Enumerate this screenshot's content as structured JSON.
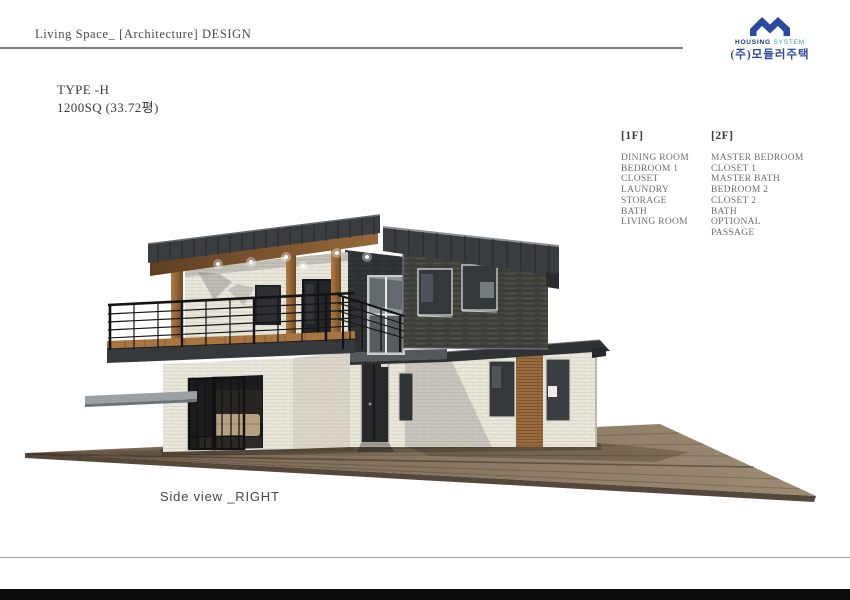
{
  "header": {
    "title": "Living Space_ [Architecture] DESIGN"
  },
  "logo": {
    "line1_strong": "HOUSING",
    "line1_light": "SYSTEM",
    "line2": "(주)모듈러주택"
  },
  "title": {
    "type": "TYPE -H",
    "area": "1200SQ (33.72평)"
  },
  "floors": [
    {
      "label": "[1F]",
      "rooms": [
        "DINING ROOM",
        "BEDROOM 1",
        "CLOSET",
        "LAUNDRY",
        "STORAGE",
        "BATH",
        "LIVING ROOM"
      ]
    },
    {
      "label": "[2F]",
      "rooms": [
        "MASTER BEDROOM",
        "CLOSET 1",
        "MASTER BATH",
        "BEDROOM 2",
        "CLOSET 2",
        "BATH",
        "OPTIONAL",
        "PASSAGE"
      ]
    }
  ],
  "caption": "Side view _RIGHT",
  "colors": {
    "logo_blue": "#2b4a9e",
    "logo_teal": "#3aa3a0",
    "roof_charcoal": "#3a3d40",
    "stone_dark": "#43473f",
    "brick_white": "#eae7dd",
    "wood": "#9a6b3e",
    "text_dark": "#3f3f3f",
    "text_gray": "#6e6e6e"
  }
}
